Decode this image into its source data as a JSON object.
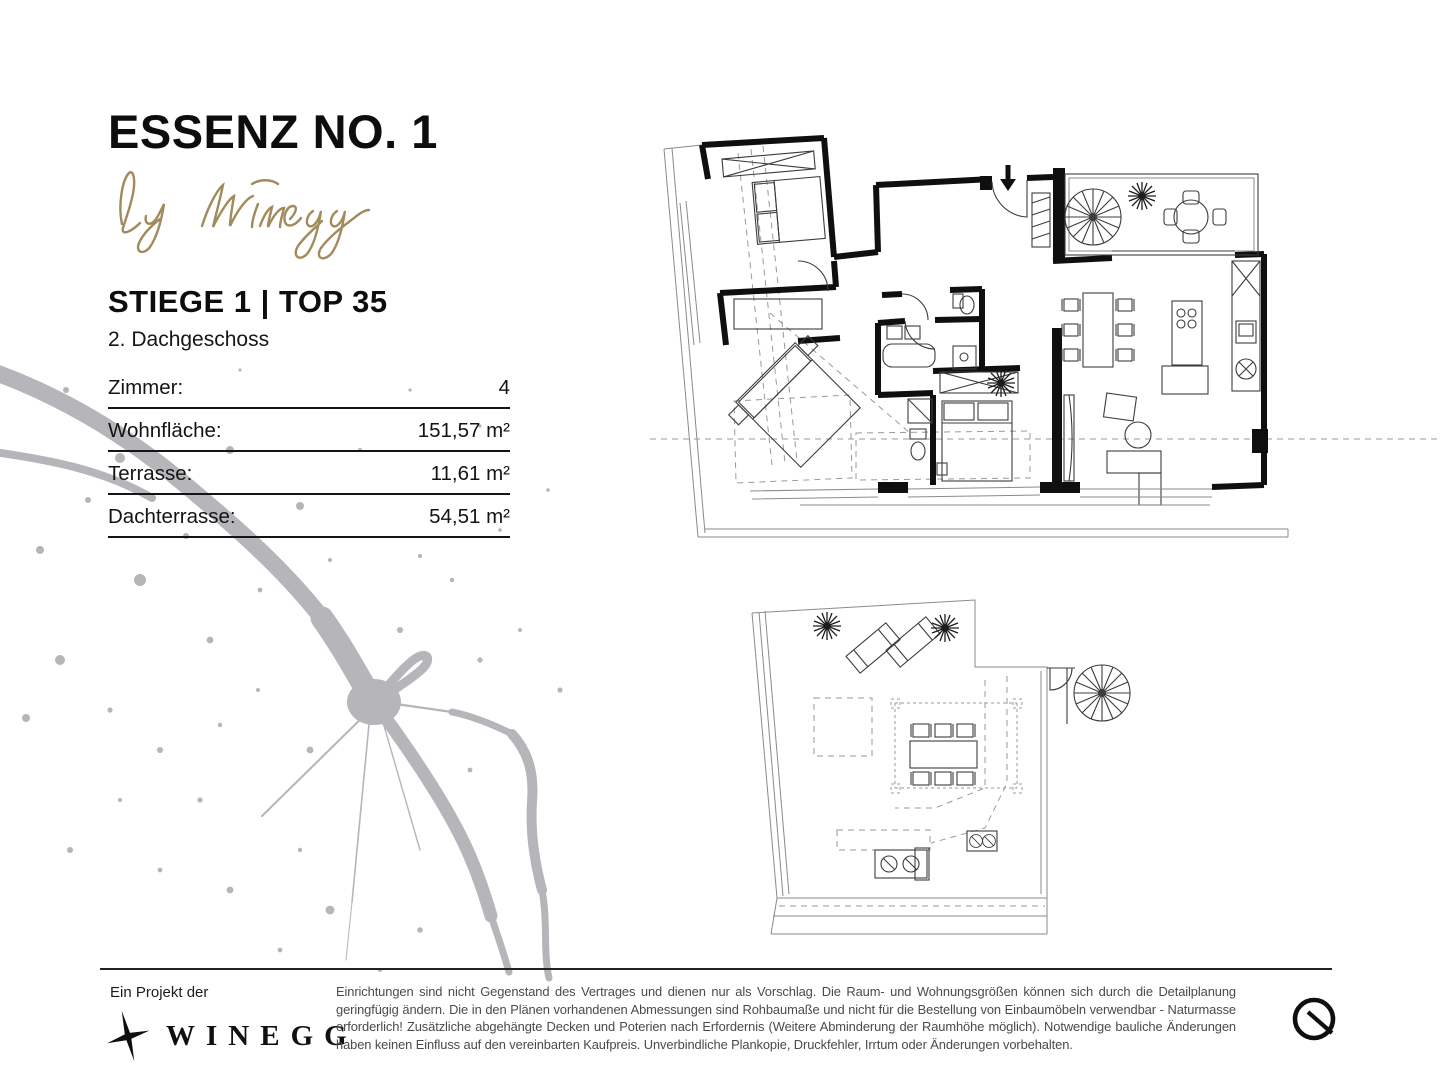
{
  "brand": {
    "title": "ESSENZ NO. 1",
    "tagline": "by Winegg"
  },
  "unit": {
    "heading": "STIEGE 1 | TOP 35",
    "floor": "2. Dachgeschoss"
  },
  "details": {
    "rows": [
      {
        "label": "Zimmer:",
        "value": "4"
      },
      {
        "label": "Wohnfläche:",
        "value": "151,57 m²"
      },
      {
        "label": "Terrasse:",
        "value": "11,61 m²"
      },
      {
        "label": "Dachterrasse:",
        "value": "54,51 m²"
      }
    ]
  },
  "footer": {
    "project_label": "Ein Projekt der",
    "company": "WINEGG",
    "disclaimer": "Einrichtungen sind nicht Gegenstand des Vertrages und dienen nur als Vorschlag. Die Raum- und Wohnungsgrößen können sich durch die Detailplanung geringfügig ändern. Die in den Plänen vorhandenen Abmessungen sind Rohbaumaße und nicht für die Bestellung von Einbaumöbeln verwendbar - Naturmasse erforderlich! Zusätzliche abgehängte Decken und Poterien nach Erfordernis (Weitere Abminderung der Raumhöhe möglich). Notwendige bauliche Änderungen haben keinen Einfluss auf den vereinbarten Kaufpreis. Unverbindliche Plankopie, Druckfehler, Irrtum oder Änderungen vorbehalten."
  },
  "colors": {
    "gold": "#A18A5C",
    "splatter": "#b5b5ba",
    "ink": "#0f0f0f",
    "gray_text": "#4a4a4a"
  }
}
